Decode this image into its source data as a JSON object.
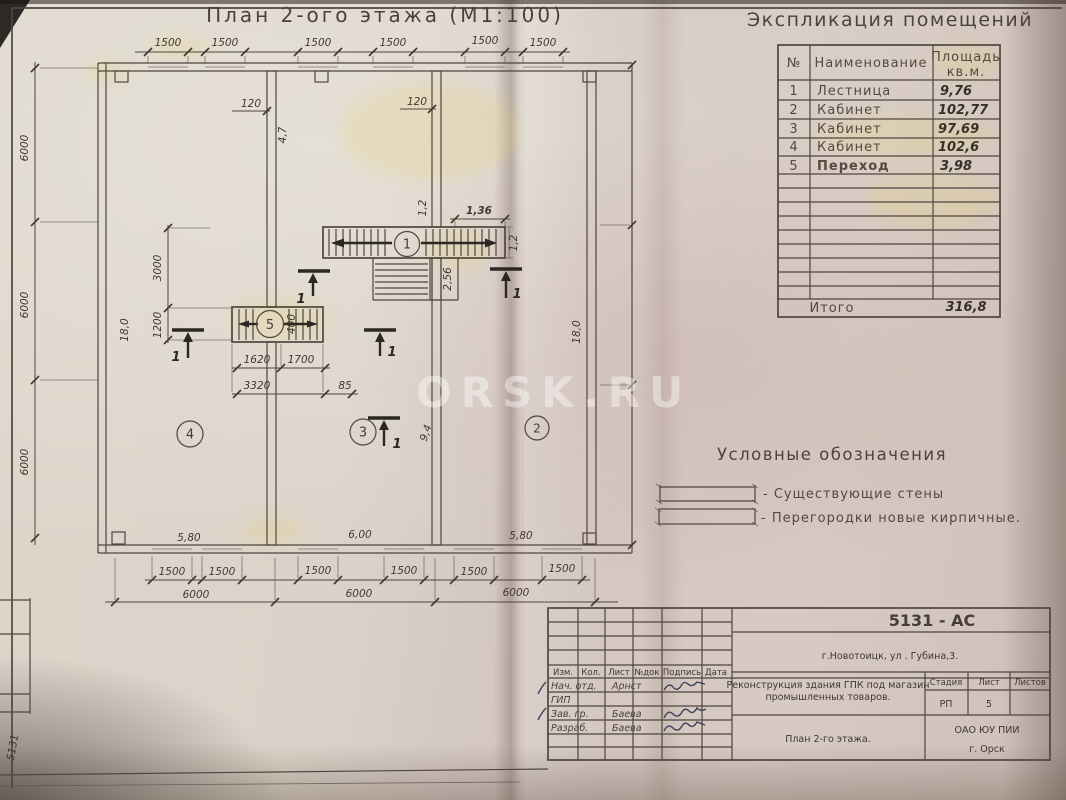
{
  "plan_title": "План 2-ого этажа (М1:100)",
  "watermark": "ORSK.RU",
  "edge_stamp": "5131",
  "explication": {
    "title": "Экспликация помещений",
    "col_num": "№",
    "col_name": "Наименование",
    "col_area1": "Площадь",
    "col_area2": "кв.м.",
    "rows": [
      {
        "num": "1",
        "name": "Лестница",
        "area": "9,76"
      },
      {
        "num": "2",
        "name": "Кабинет",
        "area": "102,77"
      },
      {
        "num": "3",
        "name": "Кабинет",
        "area": "97,69"
      },
      {
        "num": "4",
        "name": "Кабинет",
        "area": "102,6"
      },
      {
        "num": "5",
        "name": "Переход",
        "area": "3,98"
      }
    ],
    "total_label": "Итого",
    "total_value": "316,8"
  },
  "legend": {
    "title": "Условные обозначения",
    "existing_walls": "- Существующие стены",
    "new_partitions": "- Перегородки новые кирпичные."
  },
  "rooms": {
    "r1": "1",
    "r2": "2",
    "r3": "3",
    "r4": "4",
    "r5": "5"
  },
  "dims": {
    "w1500": "1500",
    "bay6000": "6000",
    "d120": "120",
    "d4_7": "4,7",
    "d1_2": "1,2",
    "d1_36": "1,36",
    "d2_56": "2,56",
    "d3000": "3000",
    "d1200": "1200",
    "d400": "400",
    "d1620": "1620",
    "d1700": "1700",
    "d3320": "3320",
    "d85": "85",
    "d18": "18,0",
    "d9_4": "9,4",
    "d5_80": "5,80",
    "d6_00": "6,00",
    "section": "1"
  },
  "title_block": {
    "code": "5131 - АС",
    "address": "г.Новотоицк, ул . Губина,3.",
    "project1": "Реконструкция здания ГПК под магазин",
    "project2": "промышленных товаров.",
    "sheet_name": "План 2-го этажа.",
    "org1": "ОАО ЮУ  ПИИ",
    "org2": "г. Орск",
    "stage_label": "Стадия",
    "sheet_label": "Лист",
    "sheets_label": "Листов",
    "stage": "РП",
    "sheet_num": "5",
    "h_izm": "Изм.",
    "h_kol": "Кол.",
    "h_list": "Лист",
    "h_ndok": "№док",
    "h_podpis": "Подпись",
    "h_data": "Дата",
    "r1_role": "Нач. отд.",
    "r1_name": "Арнст",
    "r2_role": "ГИП",
    "r3_role": "Зав. гр.",
    "r3_name": "Баева",
    "r4_role": "Разраб.",
    "r4_name": "Баева"
  }
}
